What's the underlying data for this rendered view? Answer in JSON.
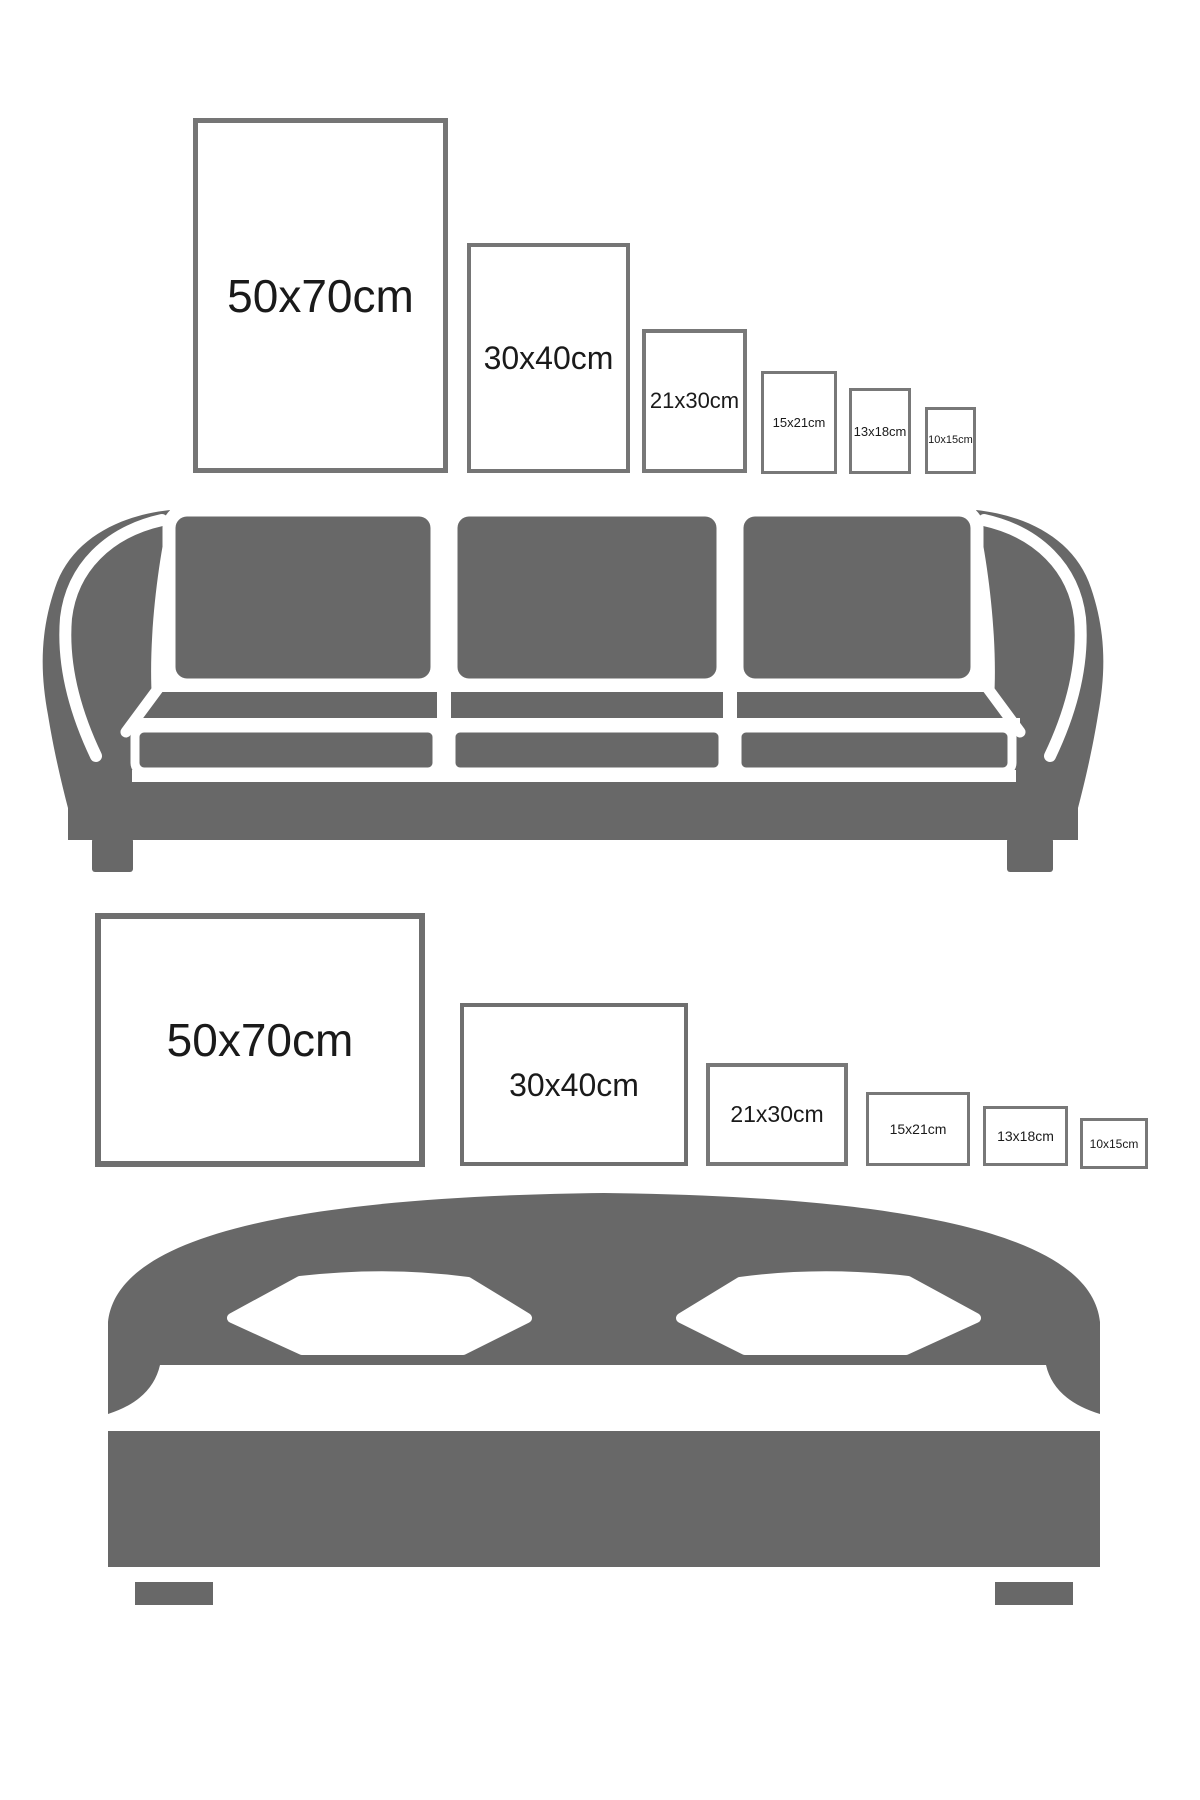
{
  "title": "Picture frame size comparison guide",
  "colors": {
    "background": "#ffffff",
    "furniture_gray": "#686868",
    "frame_border_large": "#6f6f6f",
    "frame_border": "#787878",
    "label_text": "#1a1a1a"
  },
  "sofa_section": {
    "illustration": "sofa-icon",
    "orientation": "portrait",
    "frames": [
      {
        "label": "50x70cm"
      },
      {
        "label": "30x40cm"
      },
      {
        "label": "21x30cm"
      },
      {
        "label": "15x21cm"
      },
      {
        "label": "13x18cm"
      },
      {
        "label": "10x15cm"
      }
    ]
  },
  "bed_section": {
    "illustration": "bed-icon",
    "orientation": "landscape",
    "frames": [
      {
        "label": "50x70cm"
      },
      {
        "label": "30x40cm"
      },
      {
        "label": "21x30cm"
      },
      {
        "label": "15x21cm"
      },
      {
        "label": "13x18cm"
      },
      {
        "label": "10x15cm"
      }
    ]
  }
}
